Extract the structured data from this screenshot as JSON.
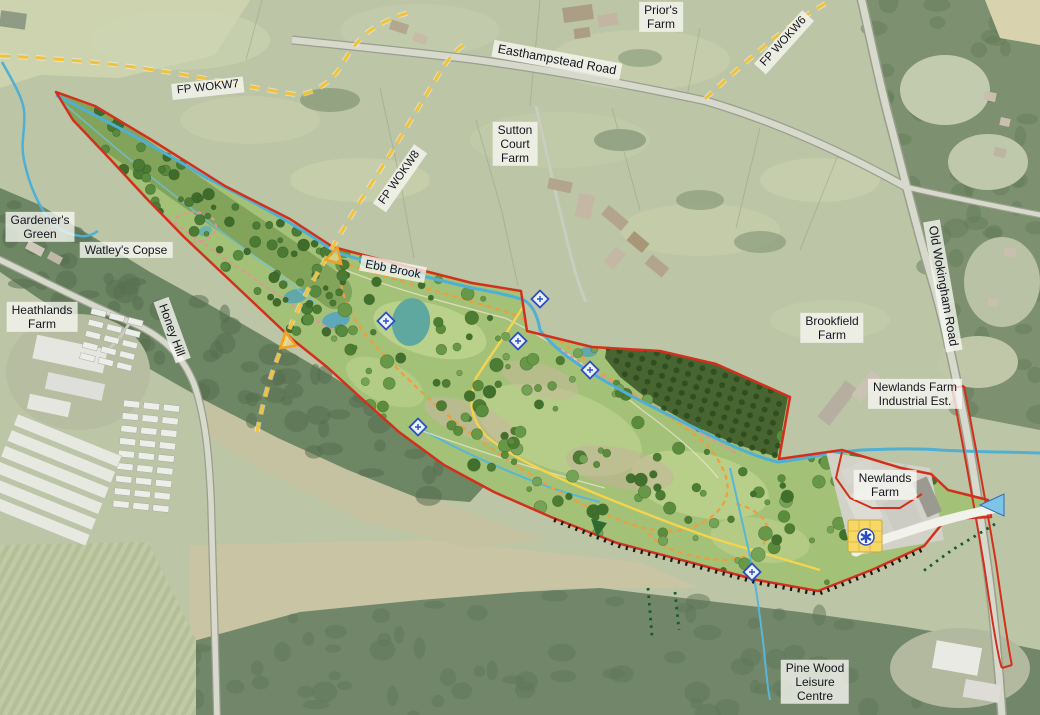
{
  "map": {
    "type": "aerial-landscape-masterplan",
    "labels": {
      "priors_farm": {
        "lines": [
          "Prior's",
          "Farm"
        ]
      },
      "easthampstead_road": {
        "text": "Easthampstead Road"
      },
      "fp_wokw6": {
        "text": "FP WOKW6"
      },
      "fp_wokw7": {
        "text": "FP WOKW7"
      },
      "fp_wokw8": {
        "text": "FP WOKW8"
      },
      "sutton_court_farm": {
        "lines": [
          "Sutton",
          "Court",
          "Farm"
        ]
      },
      "gardeners_green": {
        "lines": [
          "Gardener's",
          "Green"
        ]
      },
      "watleys_copse": {
        "text": "Watley's Copse"
      },
      "heathlands_farm": {
        "lines": [
          "Heathlands",
          "Farm"
        ]
      },
      "honey_hill": {
        "text": "Honey Hill"
      },
      "ebb_brook": {
        "text": "Ebb Brook"
      },
      "brookfield_farm": {
        "lines": [
          "Brookfield",
          "Farm"
        ]
      },
      "old_wokingham_road": {
        "text": "Old Wokingham Road"
      },
      "newlands_farm_industrial": {
        "lines": [
          "Newlands Farm",
          "Industrial Est."
        ]
      },
      "newlands_farm": {
        "lines": [
          "Newlands",
          "Farm"
        ]
      },
      "pine_wood_leisure": {
        "lines": [
          "Pine Wood",
          "Leisure",
          "Centre"
        ]
      }
    },
    "colors": {
      "site_boundary": "#d2301c",
      "public_footpath": "#f1c33c",
      "watercourse": "#4fb0d4",
      "proposed_path_primary": "#ef9e3a",
      "proposed_path_secondary": "#e8909a",
      "plantation": "#476530",
      "parkland": "#a4c178",
      "hub_building": "#f6d965",
      "access_marker": "#2b4fc2"
    }
  }
}
